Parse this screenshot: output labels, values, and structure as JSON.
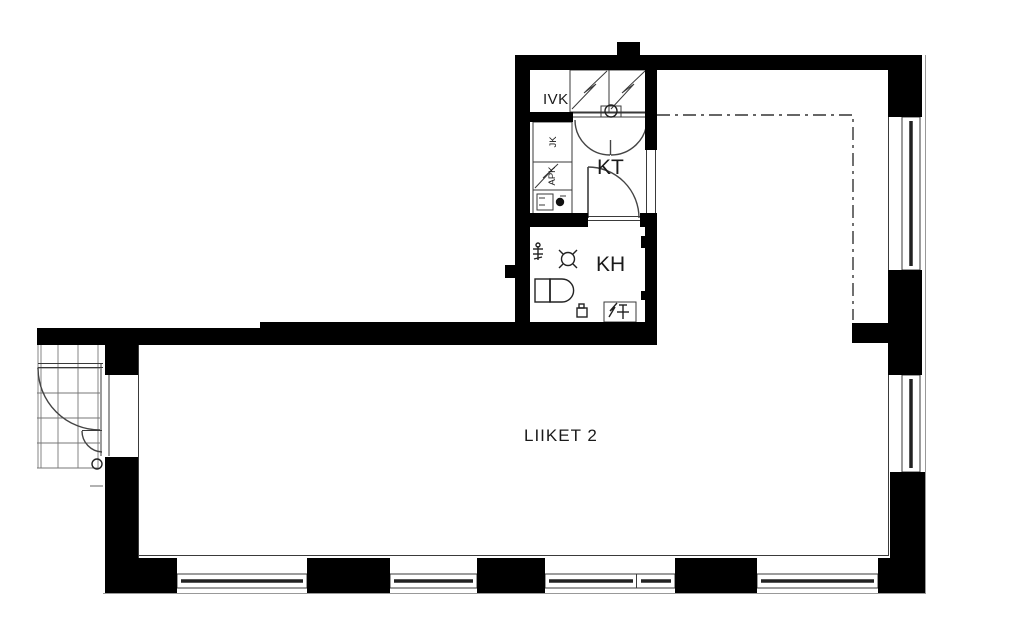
{
  "labels": {
    "ivk": "IVK",
    "kt": "KT",
    "kh": "KH",
    "liiket2": "LIIKET 2",
    "jk": "JK",
    "apk": "APK"
  },
  "colors": {
    "wall": "#000000",
    "line": "#3a3a3a",
    "text": "#1a1a1a",
    "background": "#ffffff"
  },
  "symbols": {
    "ventilation-cabinet": "rectangle with zigzag diagonal",
    "cabinet-double-door": "two quarter arcs",
    "door-swing": "leaf line with quarter arc",
    "toilet": "tank with rounded bowl",
    "floor-drain": "circle with corner ticks",
    "shower": "line with ticks",
    "washing-machine-reservation": "box with zigzag and cross",
    "sink": "rect with basin and drain circle",
    "window": "double line with dark glazing core",
    "entrance-grid": "stair grating",
    "open-ceiling-boundary": "dash-dot line"
  }
}
